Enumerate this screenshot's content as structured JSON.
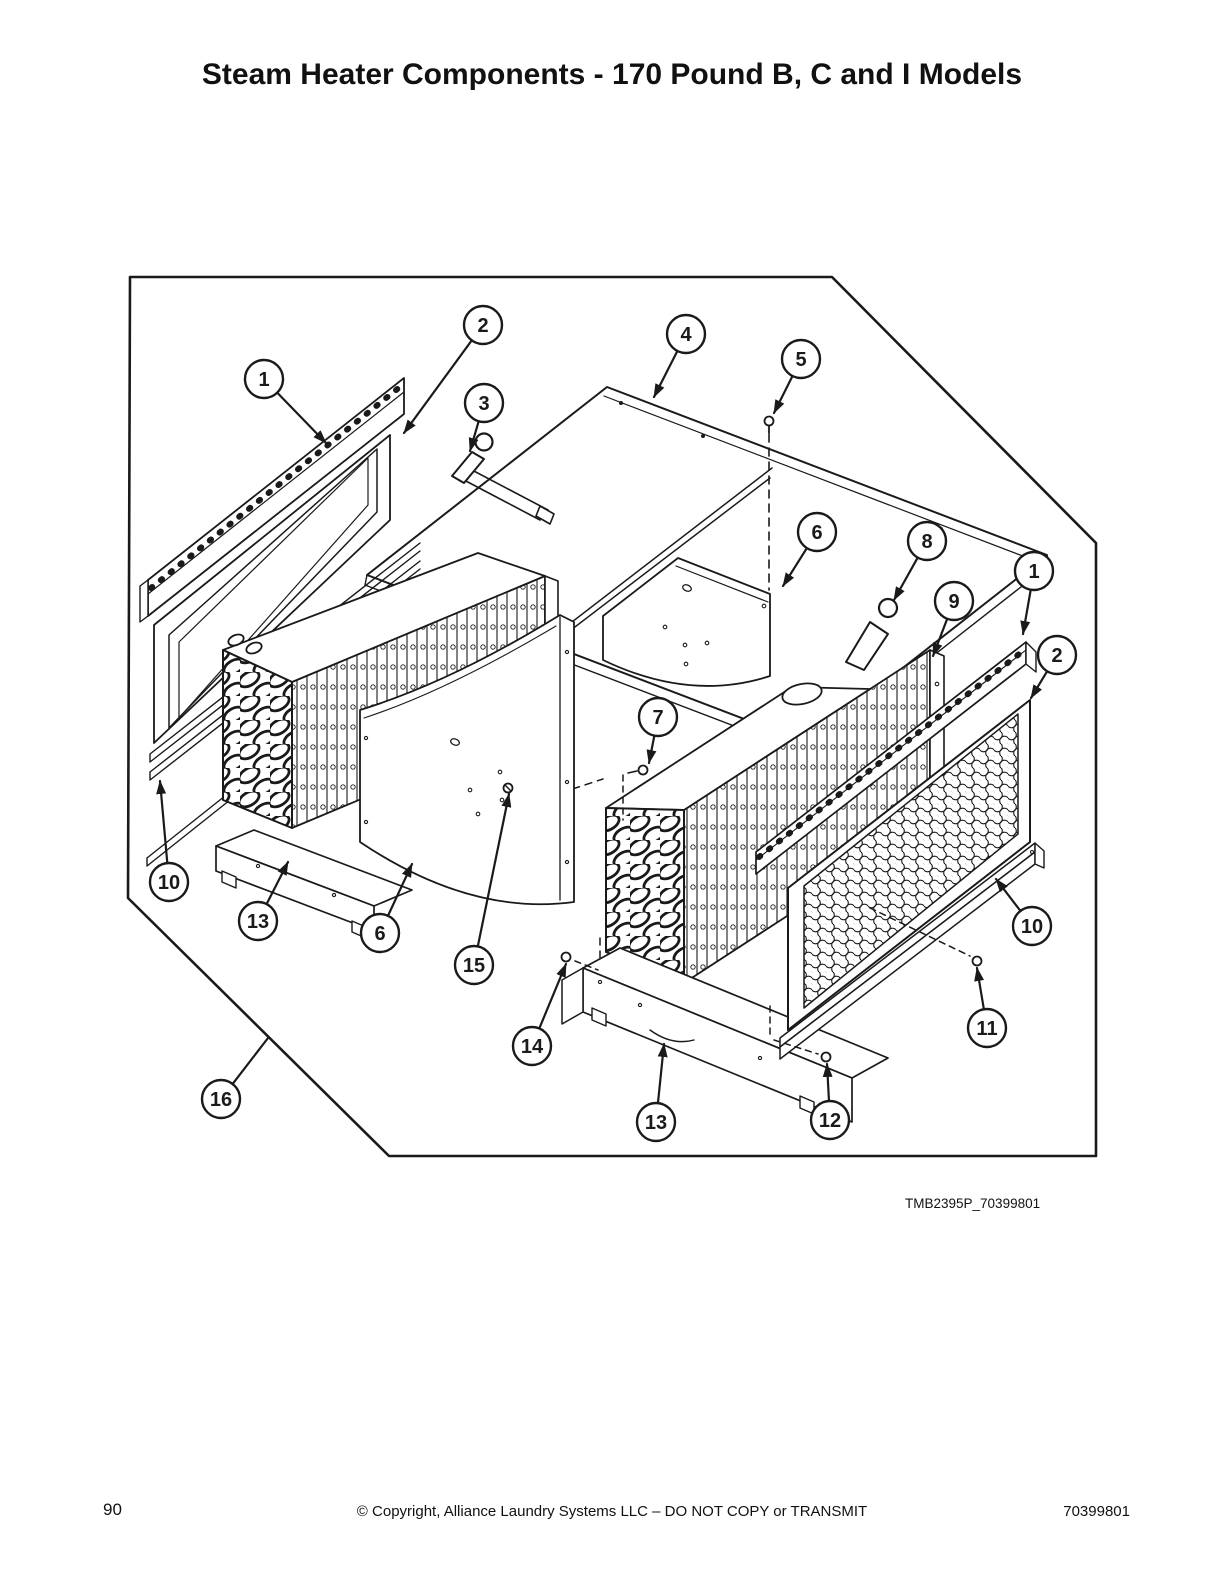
{
  "page": {
    "title": "Steam Heater Components - 170 Pound B, C and I Models",
    "figure_code": "TMB2395P_70399801",
    "footer": {
      "page_number": "90",
      "copyright": "© Copyright, Alliance Laundry Systems LLC – DO NOT COPY or TRANSMIT",
      "doc_number": "70399801"
    }
  },
  "diagram": {
    "line_color": "#1a1a1a",
    "callout_radius": 19,
    "callouts": [
      {
        "n": "1",
        "cx": 264,
        "cy": 379,
        "tx": 326,
        "ty": 443,
        "arrow": true
      },
      {
        "n": "2",
        "cx": 483,
        "cy": 325,
        "tx": 404,
        "ty": 433,
        "arrow": true
      },
      {
        "n": "3",
        "cx": 484,
        "cy": 403,
        "tx": 470,
        "ty": 451,
        "arrow": true
      },
      {
        "n": "4",
        "cx": 686,
        "cy": 334,
        "tx": 654,
        "ty": 397,
        "arrow": true
      },
      {
        "n": "5",
        "cx": 801,
        "cy": 359,
        "tx": 774,
        "ty": 413,
        "arrow": true
      },
      {
        "n": "6",
        "cx": 817,
        "cy": 532,
        "tx": 783,
        "ty": 586,
        "arrow": true
      },
      {
        "n": "8",
        "cx": 927,
        "cy": 541,
        "tx": 894,
        "ty": 600,
        "arrow": true
      },
      {
        "n": "9",
        "cx": 954,
        "cy": 601,
        "tx": 933,
        "ty": 656,
        "arrow": true
      },
      {
        "n": "1",
        "cx": 1034,
        "cy": 571,
        "tx": 1023,
        "ty": 634,
        "arrow": true
      },
      {
        "n": "2",
        "cx": 1057,
        "cy": 655,
        "tx": 1031,
        "ty": 698,
        "arrow": true
      },
      {
        "n": "7",
        "cx": 658,
        "cy": 717,
        "tx": 649,
        "ty": 763,
        "arrow": true
      },
      {
        "n": "10",
        "cx": 169,
        "cy": 882,
        "tx": 160,
        "ty": 781,
        "arrow": true
      },
      {
        "n": "13",
        "cx": 258,
        "cy": 921,
        "tx": 288,
        "ty": 862,
        "arrow": true
      },
      {
        "n": "6",
        "cx": 380,
        "cy": 933,
        "tx": 412,
        "ty": 864,
        "arrow": true
      },
      {
        "n": "15",
        "cx": 474,
        "cy": 965,
        "tx": 509,
        "ty": 794,
        "arrow": true
      },
      {
        "n": "14",
        "cx": 532,
        "cy": 1046,
        "tx": 566,
        "ty": 964,
        "arrow": true
      },
      {
        "n": "13",
        "cx": 656,
        "cy": 1122,
        "tx": 664,
        "ty": 1044,
        "arrow": true
      },
      {
        "n": "12",
        "cx": 830,
        "cy": 1120,
        "tx": 827,
        "ty": 1064,
        "arrow": true
      },
      {
        "n": "11",
        "cx": 987,
        "cy": 1028,
        "tx": 977,
        "ty": 968,
        "arrow": true
      },
      {
        "n": "10",
        "cx": 1032,
        "cy": 926,
        "tx": 996,
        "ty": 879,
        "arrow": true
      },
      {
        "n": "16",
        "cx": 221,
        "cy": 1099,
        "tx": 268,
        "ty": 1038,
        "arrow": false
      }
    ]
  }
}
